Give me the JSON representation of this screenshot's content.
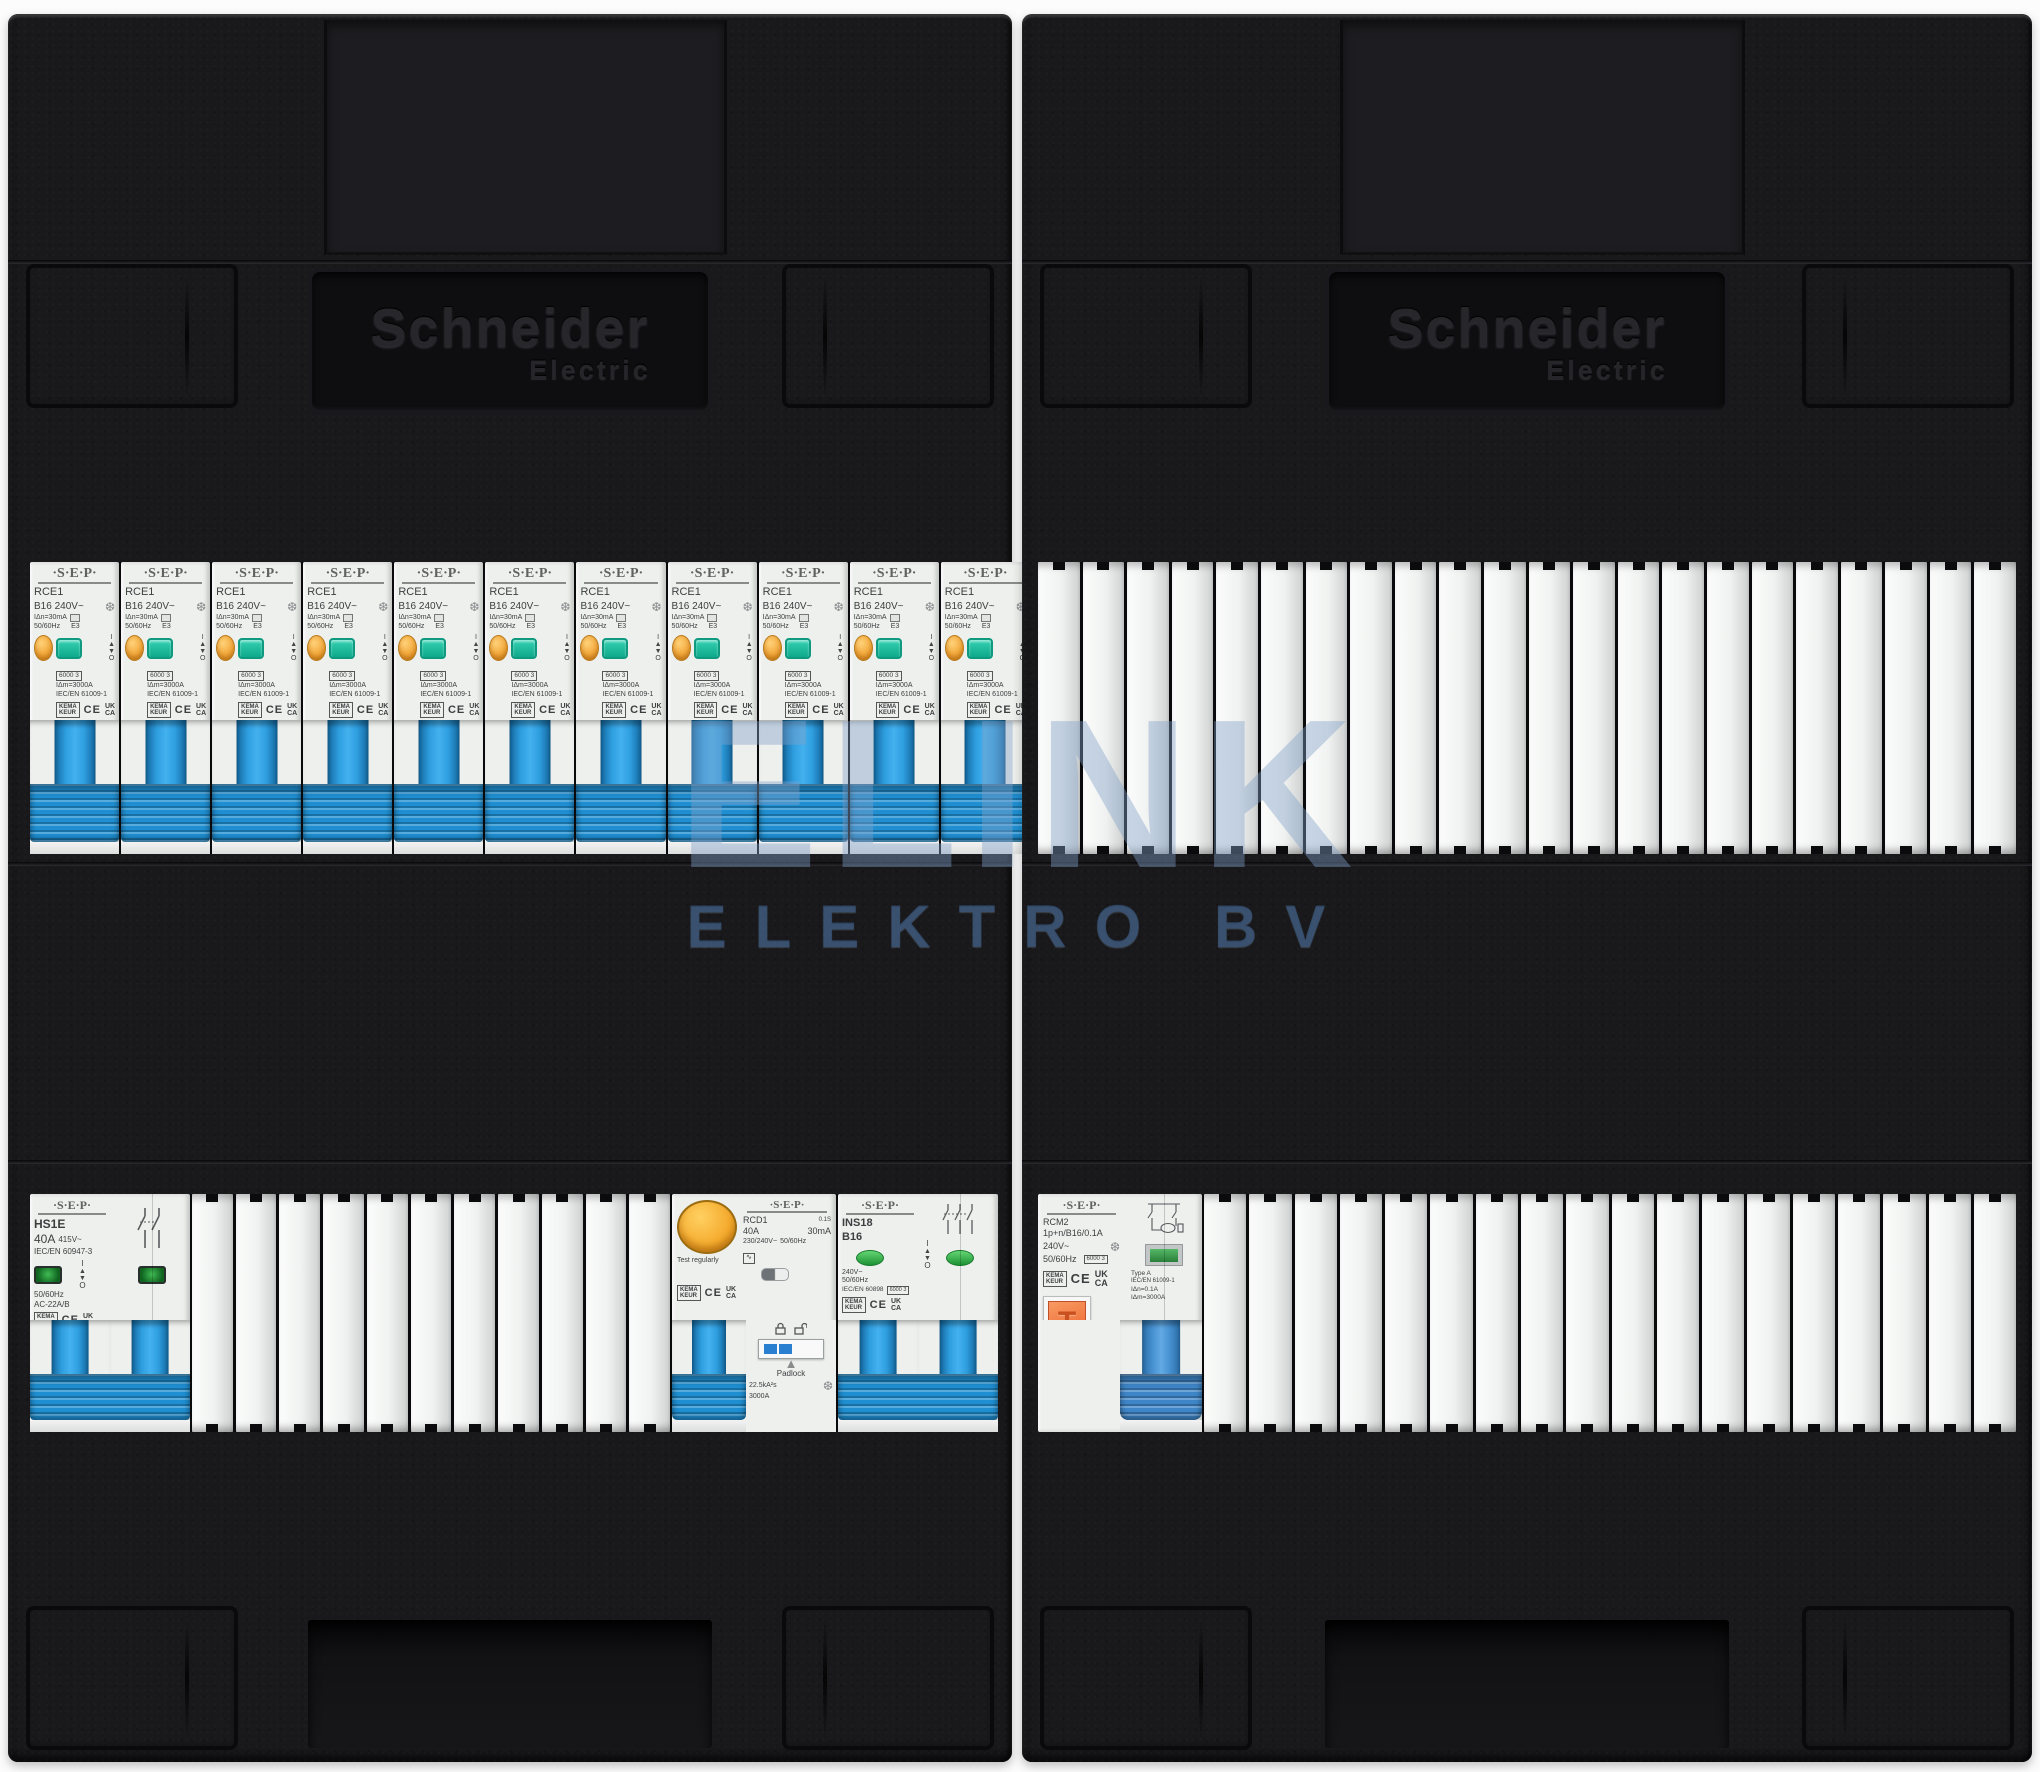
{
  "watermark": {
    "line1": "ELINK",
    "line2": "ELEKTRO BV"
  },
  "brand_plate": {
    "line1": "Schneider",
    "line2": "Electric"
  },
  "marks": {
    "kema_top": "KEMA",
    "kema_bot": "KEUR",
    "ce": "CE",
    "uk": "UK",
    "ca": "CA"
  },
  "io": {
    "on": "I",
    "off": "O"
  },
  "rce1": {
    "count": 12,
    "brand": "·S·E·P·",
    "model": "RCE1",
    "rating": "B16  240V~",
    "sensitivity": "IΔn=30mA",
    "freq": "50/60Hz",
    "e3": "E3",
    "breaking_box": "6000 3",
    "idm": "IΔm=3000A",
    "standard": "IEC/EN 61009-1"
  },
  "hs1e": {
    "brand": "·S·E·P·",
    "model": "HS1E",
    "rating": "40A",
    "voltage": "415V~",
    "standard": "IEC/EN 60947-3",
    "freq": "50/60Hz",
    "utilization": "AC-22A/B"
  },
  "rcd1": {
    "brand": "·S·E·P·",
    "model": "RCD1",
    "delay": "0.1S",
    "rating": "40A",
    "sensitivity": "30mA",
    "voltage": "230/240V~",
    "freq": "50/60Hz",
    "test_label": "Test regularly",
    "padlock_label": "Padlock",
    "i2t": "22.5kA²s",
    "icn": "3000A"
  },
  "ins18": {
    "brand": "·S·E·P·",
    "model": "INS18",
    "rating": "B16",
    "voltage": "240V~",
    "freq": "50/60Hz",
    "standard": "IEC/EN 60898",
    "breaking_box": "6000 3"
  },
  "rcm2": {
    "brand": "·S·E·P·",
    "model": "RCM2",
    "spec": "1p+n/B16/0.1A",
    "voltage": "240V~",
    "freq": "50/60Hz",
    "breaking_box": "6000 3",
    "type": "Type A",
    "standard": "IEC/EN 61009-1",
    "idn": "IΔn=0.1A",
    "idm": "IΔm=3000A",
    "test_btn": "T",
    "test_label": "TEST monthly"
  },
  "covers": {
    "right_top_count": 22,
    "left_bottom_count": 11,
    "right_bottom_count": 18
  },
  "colors": {
    "panel_black": "#19191c",
    "toggle_blue": "#1f8fd2",
    "test_orange_oval": "#f3a93c",
    "rcd_test_orange": "#f5ab2e",
    "rcm_test_orange": "#f0763f",
    "indicator_teal": "#14b596",
    "indicator_green": "#259a3a",
    "watermark_blue": "#80a0c8"
  }
}
